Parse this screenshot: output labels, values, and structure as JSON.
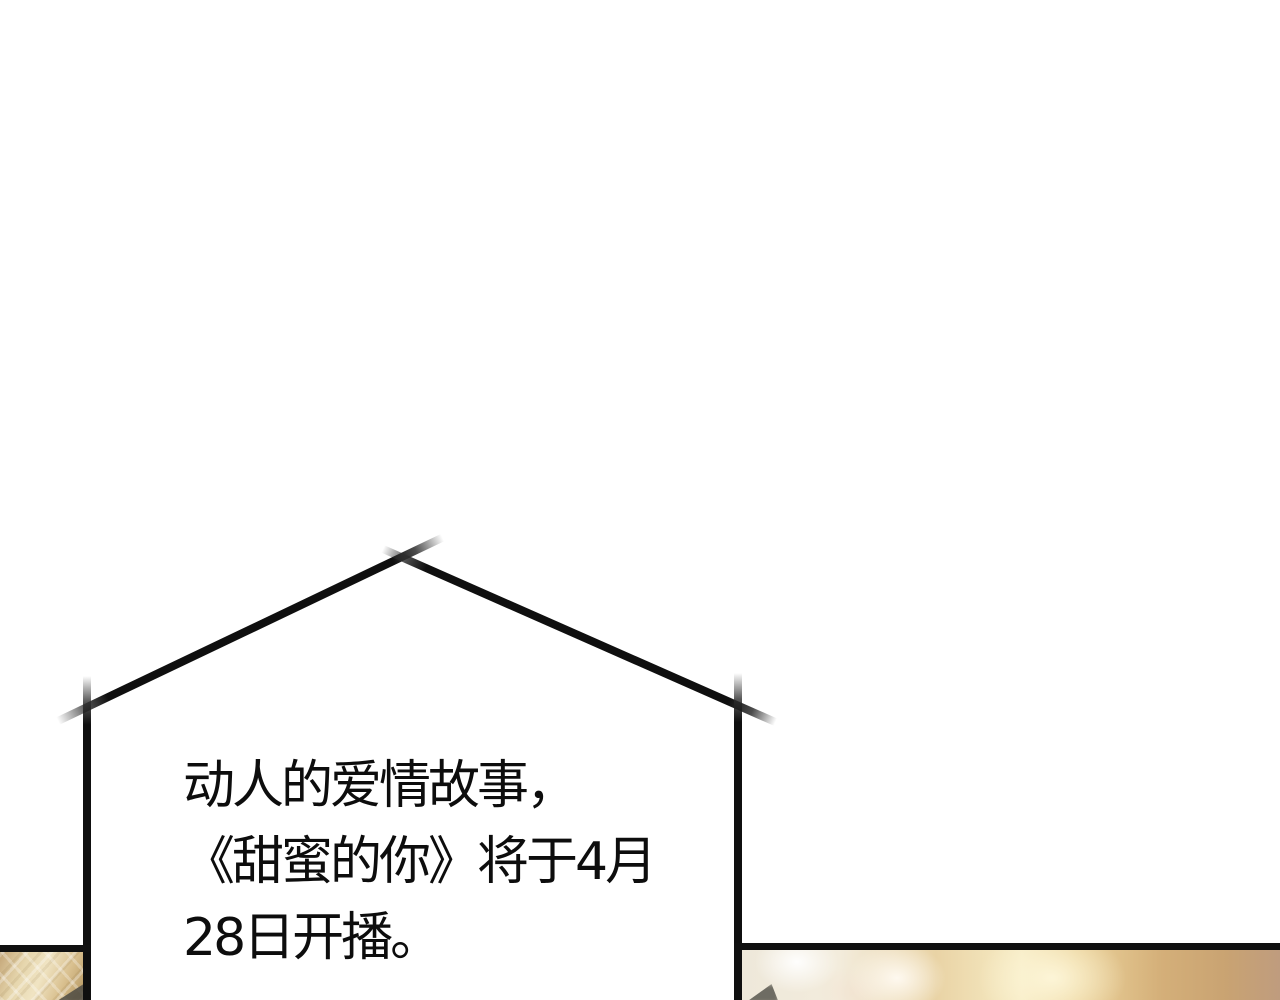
{
  "panel": {
    "kind": "webtoon-comic-panel",
    "caption": {
      "lines": [
        "动人的爱情故事，",
        "《甜蜜的你》将于4月",
        "28日开播。"
      ],
      "full_text": "动人的爱情故事，《甜蜜的你》将于4月28日开播。"
    },
    "bubble": {
      "shape": "house-outline-sketch",
      "stroke_color": "#0f0f0f"
    },
    "next_panel_preview": {
      "border_color": "#101010",
      "left_sliver_style": "golden lattice light pattern",
      "right_sliver_style": "golden bokeh glow",
      "colors": {
        "gold_light": "#f0e4c3",
        "gold_glow": "#f7ecc5",
        "gold_mid": "#d9c08f",
        "gold_deep": "#bf9c7e",
        "silhouette": "#55524a"
      }
    },
    "background_color": "#ffffff",
    "text_color": "#0d0d0d"
  }
}
